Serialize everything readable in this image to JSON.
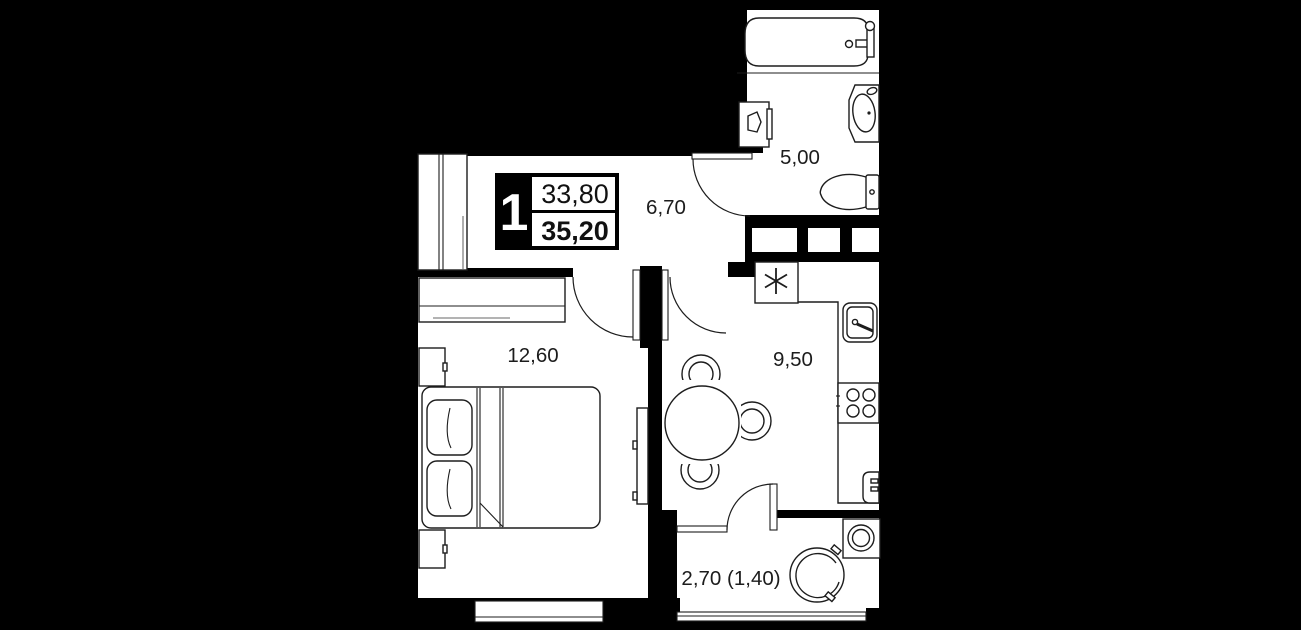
{
  "plan": {
    "badge": {
      "room_count": "1",
      "living_area": "33,80",
      "total_area": "35,20"
    },
    "rooms": {
      "bathroom": {
        "area": "5,00"
      },
      "hallway": {
        "area": "6,70"
      },
      "bedroom": {
        "area": "12,60"
      },
      "kitchen": {
        "area": "9,50"
      },
      "balcony": {
        "area": "2,70 (1,40)"
      }
    },
    "colors": {
      "background": "#000000",
      "floor": "#ffffff",
      "walls": "#000000",
      "text": "#1c1c1c"
    }
  }
}
